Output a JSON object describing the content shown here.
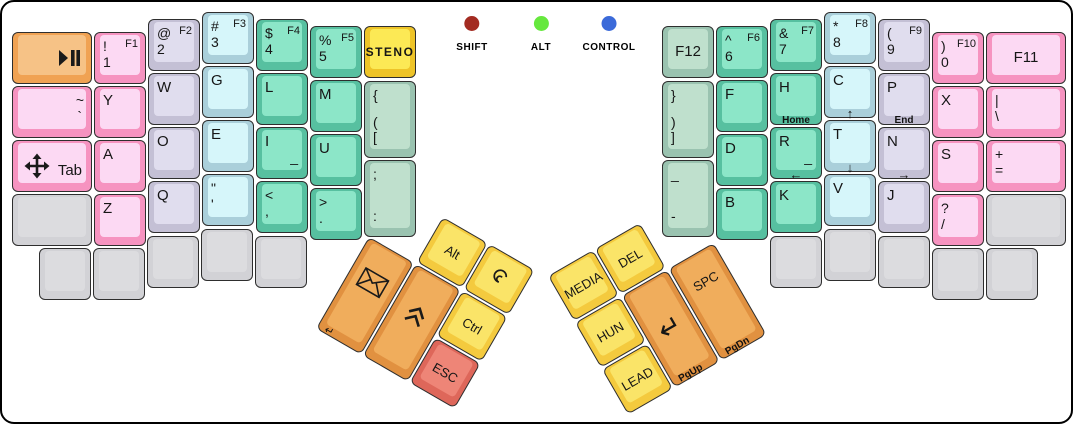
{
  "canvas": {
    "width": 1073,
    "height": 424,
    "background": "#ffffff",
    "border_color": "#000000"
  },
  "palette": {
    "pink": {
      "side": "#f693c0",
      "top": "#fcd9f3"
    },
    "lavender": {
      "side": "#c4c0d5",
      "top": "#e0ddee"
    },
    "lightblue": {
      "side": "#aacfda",
      "top": "#d6f6fa"
    },
    "teal": {
      "side": "#57c0a0",
      "top": "#8ce6c8"
    },
    "sage": {
      "side": "#9ac3b0",
      "top": "#bfe0cd"
    },
    "gold": {
      "side": "#eec428",
      "top": "#fce955"
    },
    "yellow": {
      "side": "#f4ca3e",
      "top": "#fae468"
    },
    "orange": {
      "side": "#e19140",
      "top": "#f0ad5c"
    },
    "orangelight": {
      "side": "#f0a253",
      "top": "#f6c286"
    },
    "red": {
      "side": "#de675a",
      "top": "#ee8577"
    },
    "gray": {
      "side": "#d2d2d6",
      "top": "#dcdcdf"
    }
  },
  "indicators": [
    {
      "id": "shift",
      "label": "SHIFT",
      "color": "#a32b21",
      "x": 470
    },
    {
      "id": "alt",
      "label": "ALT",
      "color": "#66e83e",
      "x": 539
    },
    {
      "id": "control",
      "label": "CONTROL",
      "color": "#3b6ad9",
      "x": 607
    }
  ],
  "clusters": {
    "left": {
      "x": 394,
      "y": 188,
      "angle": 30
    },
    "right": {
      "x": 546,
      "y": 274,
      "angle": -30
    }
  },
  "keys": [
    {
      "id": "play-pause",
      "x": 10,
      "y": 30,
      "w": 80,
      "h": 52,
      "color": "orangelight",
      "icon": "play-pause"
    },
    {
      "id": "tilde",
      "x": 10,
      "y": 84,
      "w": 80,
      "h": 52,
      "color": "pink",
      "legends": [
        {
          "t": "~",
          "p": "rt"
        },
        {
          "t": "`",
          "p": "rm"
        }
      ]
    },
    {
      "id": "tab",
      "x": 10,
      "y": 138,
      "w": 80,
      "h": 52,
      "color": "pink",
      "icon": "move",
      "legends": [
        {
          "t": "Tab",
          "p": "rm",
          "s": "main"
        }
      ]
    },
    {
      "id": "blank-l1",
      "x": 10,
      "y": 192,
      "w": 80,
      "h": 52,
      "color": "gray"
    },
    {
      "id": "1",
      "x": 92,
      "y": 30,
      "w": 52,
      "h": 52,
      "color": "pink",
      "legends": [
        {
          "t": "!",
          "p": "lt"
        },
        {
          "t": "F1",
          "p": "rt",
          "s": "f"
        },
        {
          "t": "1",
          "p": "lm"
        }
      ]
    },
    {
      "id": "y",
      "x": 92,
      "y": 84,
      "w": 52,
      "h": 52,
      "color": "pink",
      "legends": [
        {
          "t": "Y",
          "p": "lt",
          "s": "main"
        }
      ]
    },
    {
      "id": "a",
      "x": 92,
      "y": 138,
      "w": 52,
      "h": 52,
      "color": "pink",
      "legends": [
        {
          "t": "A",
          "p": "lt",
          "s": "main"
        }
      ]
    },
    {
      "id": "z",
      "x": 92,
      "y": 192,
      "w": 52,
      "h": 52,
      "color": "pink",
      "legends": [
        {
          "t": "Z",
          "p": "lt",
          "s": "main"
        }
      ]
    },
    {
      "id": "2",
      "x": 146,
      "y": 17,
      "w": 52,
      "h": 52,
      "color": "lavender",
      "legends": [
        {
          "t": "@",
          "p": "lt"
        },
        {
          "t": "F2",
          "p": "rt",
          "s": "f"
        },
        {
          "t": "2",
          "p": "lm"
        }
      ]
    },
    {
      "id": "w",
      "x": 146,
      "y": 71,
      "w": 52,
      "h": 52,
      "color": "lavender",
      "legends": [
        {
          "t": "W",
          "p": "lt",
          "s": "main"
        }
      ]
    },
    {
      "id": "o",
      "x": 146,
      "y": 125,
      "w": 52,
      "h": 52,
      "color": "lavender",
      "legends": [
        {
          "t": "O",
          "p": "lt",
          "s": "main"
        }
      ]
    },
    {
      "id": "q",
      "x": 146,
      "y": 179,
      "w": 52,
      "h": 52,
      "color": "lavender",
      "legends": [
        {
          "t": "Q",
          "p": "lt",
          "s": "main"
        }
      ]
    },
    {
      "id": "3",
      "x": 200,
      "y": 10,
      "w": 52,
      "h": 52,
      "color": "lightblue",
      "legends": [
        {
          "t": "#",
          "p": "lt"
        },
        {
          "t": "F3",
          "p": "rt",
          "s": "f"
        },
        {
          "t": "3",
          "p": "lm"
        }
      ]
    },
    {
      "id": "g",
      "x": 200,
      "y": 64,
      "w": 52,
      "h": 52,
      "color": "lightblue",
      "legends": [
        {
          "t": "G",
          "p": "lt",
          "s": "main"
        }
      ]
    },
    {
      "id": "e",
      "x": 200,
      "y": 118,
      "w": 52,
      "h": 52,
      "color": "lightblue",
      "legends": [
        {
          "t": "E",
          "p": "lt",
          "s": "main"
        }
      ]
    },
    {
      "id": "quote",
      "x": 200,
      "y": 172,
      "w": 52,
      "h": 52,
      "color": "lightblue",
      "legends": [
        {
          "t": "\"",
          "p": "lt"
        },
        {
          "t": "'",
          "p": "lm"
        }
      ]
    },
    {
      "id": "4",
      "x": 254,
      "y": 17,
      "w": 52,
      "h": 52,
      "color": "teal",
      "legends": [
        {
          "t": "$",
          "p": "lt"
        },
        {
          "t": "F4",
          "p": "rt",
          "s": "f"
        },
        {
          "t": "4",
          "p": "lm"
        }
      ]
    },
    {
      "id": "l",
      "x": 254,
      "y": 71,
      "w": 52,
      "h": 52,
      "color": "teal",
      "legends": [
        {
          "t": "L",
          "p": "lt",
          "s": "main"
        }
      ]
    },
    {
      "id": "i",
      "x": 254,
      "y": 125,
      "w": 52,
      "h": 52,
      "color": "teal",
      "legends": [
        {
          "t": "I",
          "p": "lt",
          "s": "main"
        },
        {
          "t": "_",
          "p": "rm"
        }
      ]
    },
    {
      "id": "comma",
      "x": 254,
      "y": 179,
      "w": 52,
      "h": 52,
      "color": "teal",
      "legends": [
        {
          "t": "<",
          "p": "lt"
        },
        {
          "t": ",",
          "p": "lm"
        }
      ]
    },
    {
      "id": "5",
      "x": 308,
      "y": 24,
      "w": 52,
      "h": 52,
      "color": "teal",
      "legends": [
        {
          "t": "%",
          "p": "lt"
        },
        {
          "t": "F5",
          "p": "rt",
          "s": "f"
        },
        {
          "t": "5",
          "p": "lm"
        }
      ]
    },
    {
      "id": "m",
      "x": 308,
      "y": 78,
      "w": 52,
      "h": 52,
      "color": "teal",
      "legends": [
        {
          "t": "M",
          "p": "lt",
          "s": "main"
        }
      ]
    },
    {
      "id": "u",
      "x": 308,
      "y": 132,
      "w": 52,
      "h": 52,
      "color": "teal",
      "legends": [
        {
          "t": "U",
          "p": "lt",
          "s": "main"
        }
      ]
    },
    {
      "id": "period",
      "x": 308,
      "y": 186,
      "w": 52,
      "h": 52,
      "color": "teal",
      "legends": [
        {
          "t": ">",
          "p": "lt"
        },
        {
          "t": ".",
          "p": "lm"
        }
      ]
    },
    {
      "id": "steno",
      "x": 362,
      "y": 24,
      "w": 52,
      "h": 52,
      "color": "gold",
      "legends": [
        {
          "t": "STENO",
          "p": "cm",
          "s": "steno"
        }
      ]
    },
    {
      "id": "lbracket",
      "x": 362,
      "y": 79,
      "w": 52,
      "h": 77,
      "color": "sage",
      "legends": [
        {
          "t": "{",
          "p": "lt"
        },
        {
          "t": "(",
          "p": "lm"
        },
        {
          "t": "[",
          "p": "lb"
        }
      ]
    },
    {
      "id": "semicolon",
      "x": 362,
      "y": 158,
      "w": 52,
      "h": 77,
      "color": "sage",
      "legends": [
        {
          "t": ";",
          "p": "lt"
        },
        {
          "t": ":",
          "p": "lb"
        }
      ]
    },
    {
      "id": "blank-l2",
      "x": 37,
      "y": 246,
      "w": 52,
      "h": 52,
      "color": "gray"
    },
    {
      "id": "blank-l3",
      "x": 91,
      "y": 246,
      "w": 52,
      "h": 52,
      "color": "gray"
    },
    {
      "id": "blank-l4",
      "x": 145,
      "y": 234,
      "w": 52,
      "h": 52,
      "color": "gray"
    },
    {
      "id": "blank-l5",
      "x": 199,
      "y": 227,
      "w": 52,
      "h": 52,
      "color": "gray"
    },
    {
      "id": "blank-l6",
      "x": 253,
      "y": 234,
      "w": 52,
      "h": 52,
      "color": "gray"
    },
    {
      "id": "f12",
      "x": 660,
      "y": 24,
      "w": 52,
      "h": 52,
      "color": "sage",
      "legends": [
        {
          "t": "F12",
          "p": "cm"
        }
      ]
    },
    {
      "id": "rbracket",
      "x": 660,
      "y": 79,
      "w": 52,
      "h": 77,
      "color": "sage",
      "legends": [
        {
          "t": "}",
          "p": "lt"
        },
        {
          "t": ")",
          "p": "lm"
        },
        {
          "t": "]",
          "p": "lb"
        }
      ]
    },
    {
      "id": "minus",
      "x": 660,
      "y": 158,
      "w": 52,
      "h": 77,
      "color": "sage",
      "legends": [
        {
          "t": "_",
          "p": "lt"
        },
        {
          "t": "-",
          "p": "lb"
        }
      ]
    },
    {
      "id": "6",
      "x": 714,
      "y": 24,
      "w": 52,
      "h": 52,
      "color": "teal",
      "legends": [
        {
          "t": "^",
          "p": "lt"
        },
        {
          "t": "F6",
          "p": "rt",
          "s": "f"
        },
        {
          "t": "6",
          "p": "lm"
        }
      ]
    },
    {
      "id": "f",
      "x": 714,
      "y": 78,
      "w": 52,
      "h": 52,
      "color": "teal",
      "legends": [
        {
          "t": "F",
          "p": "lt",
          "s": "main"
        }
      ]
    },
    {
      "id": "d",
      "x": 714,
      "y": 132,
      "w": 52,
      "h": 52,
      "color": "teal",
      "legends": [
        {
          "t": "D",
          "p": "lt",
          "s": "main"
        }
      ]
    },
    {
      "id": "b",
      "x": 714,
      "y": 186,
      "w": 52,
      "h": 52,
      "color": "teal",
      "legends": [
        {
          "t": "B",
          "p": "lt",
          "s": "main"
        }
      ]
    },
    {
      "id": "7",
      "x": 768,
      "y": 17,
      "w": 52,
      "h": 52,
      "color": "teal",
      "legends": [
        {
          "t": "&",
          "p": "lt"
        },
        {
          "t": "F7",
          "p": "rt",
          "s": "f"
        },
        {
          "t": "7",
          "p": "lm"
        }
      ]
    },
    {
      "id": "h",
      "x": 768,
      "y": 71,
      "w": 52,
      "h": 52,
      "color": "teal",
      "legends": [
        {
          "t": "H",
          "p": "lt",
          "s": "main"
        }
      ],
      "front": {
        "t": "Home",
        "a": "c"
      }
    },
    {
      "id": "r",
      "x": 768,
      "y": 125,
      "w": 52,
      "h": 52,
      "color": "teal",
      "legends": [
        {
          "t": "R",
          "p": "lt",
          "s": "main"
        },
        {
          "t": "_",
          "p": "rm"
        }
      ],
      "front": {
        "t": "←",
        "a": "c"
      }
    },
    {
      "id": "k",
      "x": 768,
      "y": 179,
      "w": 52,
      "h": 52,
      "color": "teal",
      "legends": [
        {
          "t": "K",
          "p": "lt",
          "s": "main"
        }
      ]
    },
    {
      "id": "8",
      "x": 822,
      "y": 10,
      "w": 52,
      "h": 52,
      "color": "lightblue",
      "legends": [
        {
          "t": "*",
          "p": "lt"
        },
        {
          "t": "F8",
          "p": "rt",
          "s": "f"
        },
        {
          "t": "8",
          "p": "lm"
        }
      ]
    },
    {
      "id": "c",
      "x": 822,
      "y": 64,
      "w": 52,
      "h": 52,
      "color": "lightblue",
      "legends": [
        {
          "t": "C",
          "p": "lt",
          "s": "main"
        }
      ],
      "front": {
        "t": "↑",
        "a": "c"
      }
    },
    {
      "id": "t",
      "x": 822,
      "y": 118,
      "w": 52,
      "h": 52,
      "color": "lightblue",
      "legends": [
        {
          "t": "T",
          "p": "lt",
          "s": "main"
        }
      ],
      "front": {
        "t": "↓",
        "a": "c"
      }
    },
    {
      "id": "v",
      "x": 822,
      "y": 172,
      "w": 52,
      "h": 52,
      "color": "lightblue",
      "legends": [
        {
          "t": "V",
          "p": "lt",
          "s": "main"
        }
      ]
    },
    {
      "id": "9",
      "x": 876,
      "y": 17,
      "w": 52,
      "h": 52,
      "color": "lavender",
      "legends": [
        {
          "t": "(",
          "p": "lt"
        },
        {
          "t": "F9",
          "p": "rt",
          "s": "f"
        },
        {
          "t": "9",
          "p": "lm"
        }
      ]
    },
    {
      "id": "p",
      "x": 876,
      "y": 71,
      "w": 52,
      "h": 52,
      "color": "lavender",
      "legends": [
        {
          "t": "P",
          "p": "lt",
          "s": "main"
        }
      ],
      "front": {
        "t": "End",
        "a": "c"
      }
    },
    {
      "id": "n",
      "x": 876,
      "y": 125,
      "w": 52,
      "h": 52,
      "color": "lavender",
      "legends": [
        {
          "t": "N",
          "p": "lt",
          "s": "main"
        }
      ],
      "front": {
        "t": "→",
        "a": "c"
      }
    },
    {
      "id": "j",
      "x": 876,
      "y": 179,
      "w": 52,
      "h": 52,
      "color": "lavender",
      "legends": [
        {
          "t": "J",
          "p": "lt",
          "s": "main"
        }
      ]
    },
    {
      "id": "0",
      "x": 930,
      "y": 30,
      "w": 52,
      "h": 52,
      "color": "pink",
      "legends": [
        {
          "t": ")",
          "p": "lt"
        },
        {
          "t": "F10",
          "p": "rt",
          "s": "f"
        },
        {
          "t": "0",
          "p": "lm"
        }
      ]
    },
    {
      "id": "x",
      "x": 930,
      "y": 84,
      "w": 52,
      "h": 52,
      "color": "pink",
      "legends": [
        {
          "t": "X",
          "p": "lt",
          "s": "main"
        }
      ]
    },
    {
      "id": "s",
      "x": 930,
      "y": 138,
      "w": 52,
      "h": 52,
      "color": "pink",
      "legends": [
        {
          "t": "S",
          "p": "lt",
          "s": "main"
        }
      ]
    },
    {
      "id": "slash",
      "x": 930,
      "y": 192,
      "w": 52,
      "h": 52,
      "color": "pink",
      "legends": [
        {
          "t": "?",
          "p": "lt"
        },
        {
          "t": "/",
          "p": "lm"
        }
      ]
    },
    {
      "id": "f11",
      "x": 984,
      "y": 30,
      "w": 80,
      "h": 52,
      "color": "pink",
      "legends": [
        {
          "t": "F11",
          "p": "cm"
        }
      ]
    },
    {
      "id": "backslash",
      "x": 984,
      "y": 84,
      "w": 80,
      "h": 52,
      "color": "pink",
      "legends": [
        {
          "t": "|",
          "p": "lt"
        },
        {
          "t": "\\",
          "p": "lm"
        }
      ]
    },
    {
      "id": "equals",
      "x": 984,
      "y": 138,
      "w": 80,
      "h": 52,
      "color": "pink",
      "legends": [
        {
          "t": "+",
          "p": "lt"
        },
        {
          "t": "=",
          "p": "lm"
        }
      ]
    },
    {
      "id": "blank-r1",
      "x": 984,
      "y": 192,
      "w": 80,
      "h": 52,
      "color": "gray"
    },
    {
      "id": "blank-r2",
      "x": 768,
      "y": 234,
      "w": 52,
      "h": 52,
      "color": "gray"
    },
    {
      "id": "blank-r3",
      "x": 822,
      "y": 227,
      "w": 52,
      "h": 52,
      "color": "gray"
    },
    {
      "id": "blank-r4",
      "x": 876,
      "y": 234,
      "w": 52,
      "h": 52,
      "color": "gray"
    },
    {
      "id": "blank-r5",
      "x": 930,
      "y": 246,
      "w": 52,
      "h": 52,
      "color": "gray"
    },
    {
      "id": "blank-r6",
      "x": 984,
      "y": 246,
      "w": 52,
      "h": 52,
      "color": "gray"
    },
    {
      "id": "alt",
      "cluster": "left",
      "x": 54,
      "y": 0,
      "w": 52,
      "h": 52,
      "color": "yellow",
      "legends": [
        {
          "t": "Alt",
          "p": "cm",
          "s": "thumb"
        }
      ]
    },
    {
      "id": "layer-spiral",
      "cluster": "left",
      "x": 108,
      "y": 0,
      "w": 52,
      "h": 52,
      "color": "yellow",
      "icon": "spiral"
    },
    {
      "id": "envelope",
      "cluster": "left",
      "x": 0,
      "y": 54,
      "w": 52,
      "h": 106,
      "color": "orange",
      "icon": "envelope",
      "front": {
        "t": "↵",
        "a": "l",
        "ret": true
      }
    },
    {
      "id": "shift-chevron",
      "cluster": "left",
      "x": 54,
      "y": 54,
      "w": 52,
      "h": 106,
      "color": "orange",
      "icon": "chevron-up"
    },
    {
      "id": "ctrl",
      "cluster": "left",
      "x": 108,
      "y": 54,
      "w": 52,
      "h": 52,
      "color": "yellow",
      "legends": [
        {
          "t": "Ctrl",
          "p": "cm",
          "s": "thumb"
        }
      ]
    },
    {
      "id": "esc",
      "cluster": "left",
      "x": 108,
      "y": 108,
      "w": 52,
      "h": 52,
      "color": "red",
      "legends": [
        {
          "t": "ESC",
          "p": "cm",
          "s": "thumb"
        }
      ]
    },
    {
      "id": "media",
      "cluster": "right",
      "x": 0,
      "y": 0,
      "w": 52,
      "h": 52,
      "color": "yellow",
      "legends": [
        {
          "t": "MEDIA",
          "p": "cm",
          "s": "thumb"
        }
      ]
    },
    {
      "id": "del",
      "cluster": "right",
      "x": 54,
      "y": 0,
      "w": 52,
      "h": 52,
      "color": "yellow",
      "legends": [
        {
          "t": "DEL",
          "p": "cm",
          "s": "thumb"
        }
      ]
    },
    {
      "id": "hun",
      "cluster": "right",
      "x": 0,
      "y": 54,
      "w": 52,
      "h": 52,
      "color": "yellow",
      "legends": [
        {
          "t": "HUN",
          "p": "cm",
          "s": "thumb"
        }
      ]
    },
    {
      "id": "enter",
      "cluster": "right",
      "x": 54,
      "y": 54,
      "w": 52,
      "h": 106,
      "color": "orange",
      "icon": "return",
      "front": {
        "t": "PgUp",
        "a": "l"
      }
    },
    {
      "id": "spc",
      "cluster": "right",
      "x": 108,
      "y": 54,
      "w": 52,
      "h": 106,
      "color": "orange",
      "legends": [
        {
          "t": "SPC",
          "p": "ct"
        }
      ],
      "front": {
        "t": "PgDn",
        "a": "l"
      }
    },
    {
      "id": "lead",
      "cluster": "right",
      "x": 0,
      "y": 108,
      "w": 52,
      "h": 52,
      "color": "yellow",
      "legends": [
        {
          "t": "LEAD",
          "p": "cm",
          "s": "thumb"
        }
      ]
    }
  ]
}
